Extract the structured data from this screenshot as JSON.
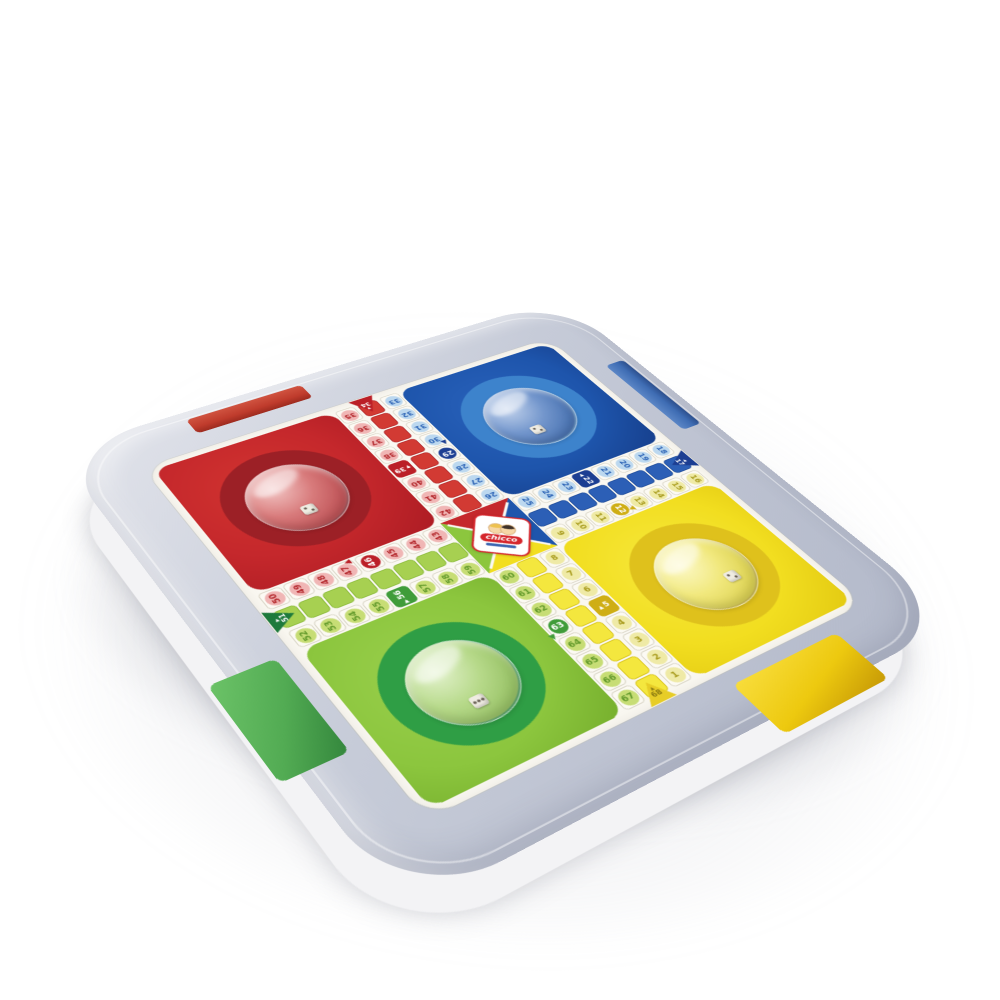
{
  "product": {
    "brand_text": "chicco",
    "description": "White plastic parcheesi (parchis) game tray with four transparent dice domes and four colored drawer tabs"
  },
  "board": {
    "quadrants": [
      {
        "color": "red",
        "pos": "top-left"
      },
      {
        "color": "blue",
        "pos": "top-right"
      },
      {
        "color": "green",
        "pos": "bottom-left"
      },
      {
        "color": "yellow",
        "pos": "bottom-right"
      }
    ],
    "arms": {
      "top": {
        "lanes": [
          {
            "kind": "nums",
            "color": "red",
            "nums": [
              "35",
              "36",
              "37",
              "38",
              "39",
              "40",
              "41",
              "42"
            ],
            "start_idx": 4,
            "start_glyph": "▼"
          },
          {
            "kind": "ladder",
            "color": "red",
            "entry": {
              "num": "34",
              "at": "start",
              "dir": "down",
              "glyph": "▼"
            }
          },
          {
            "kind": "nums",
            "color": "blue",
            "nums": [
              "33",
              "32",
              "31",
              "30",
              "29",
              "28",
              "27",
              "26"
            ],
            "safe_idx": 4,
            "dir_mark": {
              "idx": 3.4,
              "glyph": "▲",
              "edge": "right"
            }
          }
        ]
      },
      "right": {
        "lanes": [
          {
            "kind": "nums",
            "color": "blue",
            "nums": [
              "25",
              "24",
              "23",
              "22",
              "21",
              "20",
              "19",
              "18"
            ],
            "start_idx": 3,
            "start_glyph": "◀"
          },
          {
            "kind": "ladder",
            "color": "blue",
            "entry": {
              "num": "17",
              "at": "end",
              "dir": "left",
              "glyph": "◀"
            }
          },
          {
            "kind": "nums",
            "color": "yellow",
            "nums": [
              "9",
              "10",
              "11",
              "12",
              "13",
              "14",
              "15",
              "16"
            ],
            "safe_idx": 3,
            "dir_mark": {
              "idx": 3.5,
              "glyph": "▼",
              "edge": "bottom"
            }
          }
        ]
      },
      "bottom": {
        "lanes": [
          {
            "kind": "nums",
            "color": "green",
            "nums": [
              "60",
              "61",
              "62",
              "63",
              "64",
              "65",
              "66",
              "67"
            ],
            "safe_idx": 3,
            "dir_mark": {
              "idx": 3.5,
              "glyph": "▼",
              "edge": "left"
            }
          },
          {
            "kind": "ladder",
            "color": "yellow",
            "entry": {
              "num": "68",
              "at": "end",
              "dir": "up",
              "glyph": "▲"
            }
          },
          {
            "kind": "nums",
            "color": "yellow",
            "nums": [
              "8",
              "7",
              "6",
              "5",
              "4",
              "3",
              "2",
              "1"
            ],
            "start_idx": 3,
            "start_glyph": "▲"
          }
        ]
      },
      "left": {
        "lanes": [
          {
            "kind": "nums",
            "color": "red",
            "nums": [
              "50",
              "49",
              "48",
              "47",
              "46",
              "45",
              "44",
              "43"
            ],
            "safe_idx": 4,
            "dir_mark": {
              "idx": 3.4,
              "glyph": "▲",
              "edge": "top"
            }
          },
          {
            "kind": "ladder",
            "color": "green",
            "entry": {
              "num": "51",
              "at": "start",
              "dir": "right",
              "glyph": "▶"
            }
          },
          {
            "kind": "nums",
            "color": "green",
            "nums": [
              "52",
              "53",
              "54",
              "55",
              "56",
              "57",
              "58",
              "59"
            ],
            "start_idx": 4,
            "start_glyph": "▶"
          }
        ]
      }
    },
    "start_cells": [
      "5",
      "22",
      "39",
      "56"
    ],
    "safe_circle_cells": [
      "12",
      "29",
      "46",
      "63"
    ],
    "home_entry_cells": [
      "17",
      "34",
      "51",
      "68"
    ],
    "dice_in_domes": 4
  },
  "colors": {
    "red": "#c5282c",
    "red-ladder": "#d23a33",
    "red-chip-bg": "#f0b6b5",
    "red-chip-text": "#b3262b",
    "red-dark": "#bb1f27",
    "red-ring": "#9c2026",
    "blue": "#1e55ac",
    "blue-ladder": "#2c5fb6",
    "blue-chip-bg": "#bcd8ef",
    "blue-chip-text": "#2a62b5",
    "blue-dark": "#1c3e92",
    "blue-ring": "#3d83cc",
    "yellow": "#f2de20",
    "yellow-ladder": "#f4e73e",
    "yellow-chip-bg": "#efeaa6",
    "yellow-chip-text": "#a89b1c",
    "yellow-dark": "#cfae15",
    "yellow-ring": "#dfc11c",
    "green": "#8cc63e",
    "green-ladder": "#a7d051",
    "green-chip-bg": "#c7dd75",
    "green-chip-text": "#61992a",
    "green-dark": "#3f9c3a",
    "green-ring": "#2f9e45",
    "green-entry": "#1e7a3c",
    "tray-top-1": "#e2e4eb",
    "tray-top-2": "#c6cbd8",
    "tray-top-3": "#b2b8c9",
    "tray-base": "#f3f3f5",
    "tab-red": "#bf3b2c",
    "tab-blue": "#3f6db4",
    "tab-green": "#52ab53",
    "tab-yellow": "#edc90f",
    "board-bg": "#faf8f2",
    "cell-border": "#d9d5c6",
    "logo-red": "#d5262c"
  }
}
